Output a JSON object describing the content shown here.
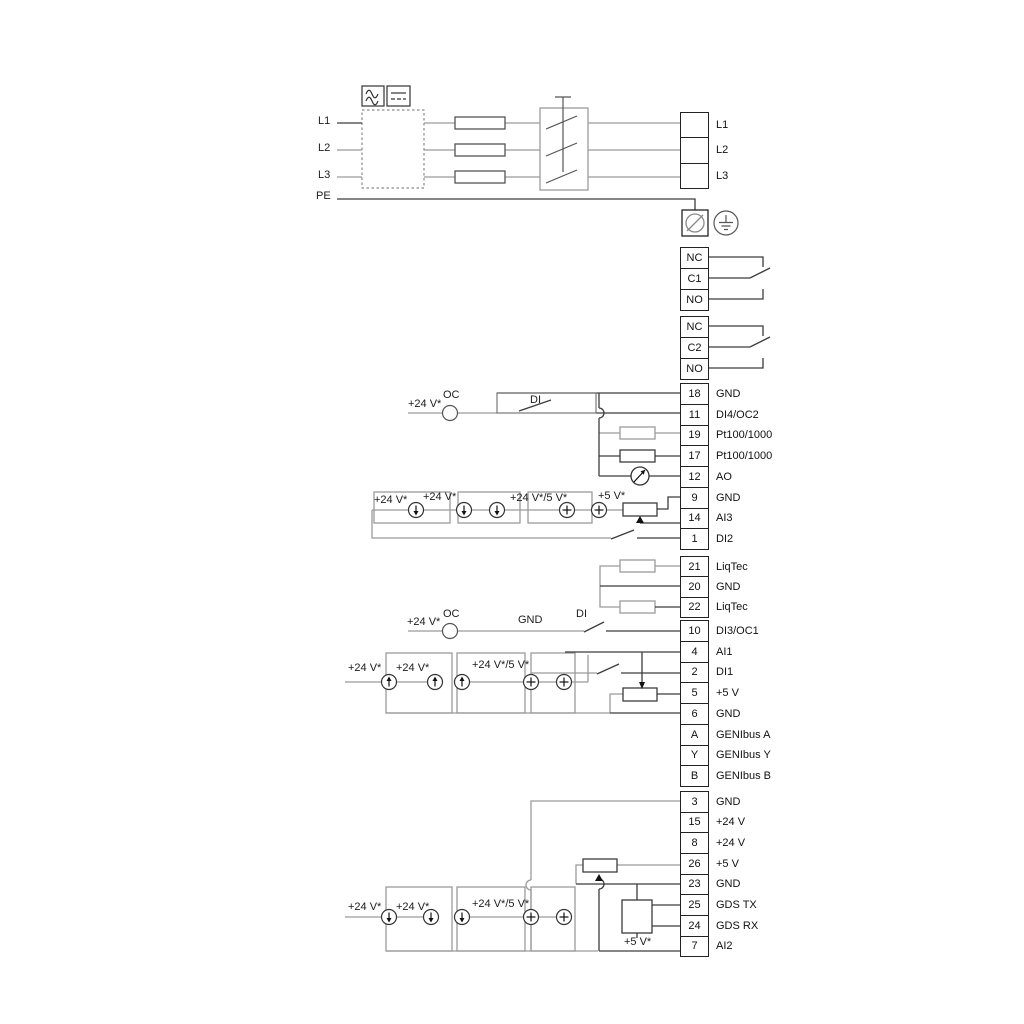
{
  "labels": {
    "l1": "L1",
    "l2": "L2",
    "l3": "L3",
    "pe": "PE",
    "p24": "+24 V*",
    "p24_5": "+24 V*/5 V*",
    "p5": "+5 V*",
    "oc": "OC",
    "di": "DI",
    "gnd": "GND"
  },
  "icons": {
    "ac_symbol": "sine-wave-icon",
    "dc_symbol": "dc-lines-icon",
    "screw_terminal": "screw-terminal-icon",
    "earth": "ground-icon",
    "meter": "analog-output-meter-icon"
  },
  "terminal_blocks": {
    "power": {
      "rows": [
        {
          "num": "",
          "label": "L1"
        },
        {
          "num": "",
          "label": "L2"
        },
        {
          "num": "",
          "label": "L3"
        }
      ]
    },
    "relay1": {
      "rows": [
        {
          "num": "NC",
          "label": ""
        },
        {
          "num": "C1",
          "label": ""
        },
        {
          "num": "NO",
          "label": ""
        }
      ]
    },
    "relay2": {
      "rows": [
        {
          "num": "NC",
          "label": ""
        },
        {
          "num": "C2",
          "label": ""
        },
        {
          "num": "NO",
          "label": ""
        }
      ]
    },
    "io1": {
      "rows": [
        {
          "num": "18",
          "label": "GND"
        },
        {
          "num": "11",
          "label": "DI4/OC2"
        },
        {
          "num": "19",
          "label": "Pt100/1000"
        },
        {
          "num": "17",
          "label": "Pt100/1000"
        },
        {
          "num": "12",
          "label": "AO"
        },
        {
          "num": "9",
          "label": "GND"
        },
        {
          "num": "14",
          "label": "AI3"
        },
        {
          "num": "1",
          "label": "DI2"
        }
      ]
    },
    "liqtec": {
      "rows": [
        {
          "num": "21",
          "label": "LiqTec"
        },
        {
          "num": "20",
          "label": "GND"
        },
        {
          "num": "22",
          "label": "LiqTec"
        }
      ]
    },
    "io2": {
      "rows": [
        {
          "num": "10",
          "label": "DI3/OC1"
        },
        {
          "num": "4",
          "label": "AI1"
        },
        {
          "num": "2",
          "label": "DI1"
        },
        {
          "num": "5",
          "label": "+5 V"
        },
        {
          "num": "6",
          "label": "GND"
        },
        {
          "num": "A",
          "label": "GENIbus A"
        },
        {
          "num": "Y",
          "label": "GENIbus Y"
        },
        {
          "num": "B",
          "label": "GENIbus B"
        }
      ]
    },
    "io3": {
      "rows": [
        {
          "num": "3",
          "label": "GND"
        },
        {
          "num": "15",
          "label": "+24 V"
        },
        {
          "num": "8",
          "label": "+24 V"
        },
        {
          "num": "26",
          "label": "+5 V"
        },
        {
          "num": "23",
          "label": "GND"
        },
        {
          "num": "25",
          "label": "GDS TX"
        },
        {
          "num": "24",
          "label": "GDS RX"
        },
        {
          "num": "7",
          "label": "AI2"
        }
      ]
    }
  },
  "colors": {
    "wire_gray": "#9b9b9b",
    "wire_dark": "#3c3c3c",
    "text": "#1c1c1c"
  }
}
